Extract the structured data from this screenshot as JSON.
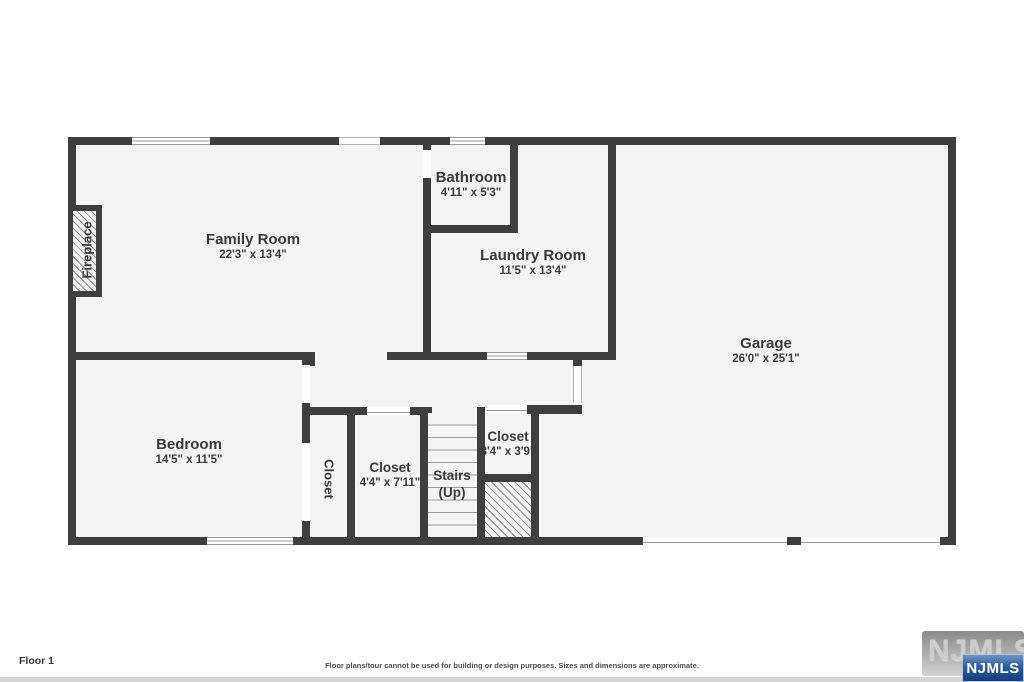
{
  "rooms": {
    "family": {
      "name": "Family Room",
      "dims": "22'3\" x 13'4\""
    },
    "bathroom": {
      "name": "Bathroom",
      "dims": "4'11\" x 5'3\""
    },
    "laundry": {
      "name": "Laundry Room",
      "dims": "11'5\" x 13'4\""
    },
    "garage": {
      "name": "Garage",
      "dims": "26'0\" x 25'1\""
    },
    "bedroom": {
      "name": "Bedroom",
      "dims": "14'5\" x 11'5\""
    },
    "closet_hall": {
      "name": "Closet",
      "dims": "4'4\" x 7'11\""
    },
    "closet_small": {
      "name": "Closet",
      "dims": "3'4\" x 3'9\""
    },
    "stairs": {
      "name": "Stairs",
      "dims": "(Up)"
    },
    "closet_bedroom": {
      "name": "Closet"
    },
    "fireplace": {
      "name": "Fireplace"
    }
  },
  "footer": {
    "floor_label": "Floor 1",
    "disclaimer": "Floor plans/tour cannot be used for building or design purposes. Sizes and dimensions are approximate."
  },
  "branding": {
    "watermark": "NJMLS",
    "badge": "NJMLS"
  },
  "colors": {
    "wall": "#3e3e3e",
    "floor_fill": "#f4f4f4",
    "badge_blue": "#2a5ca3"
  }
}
